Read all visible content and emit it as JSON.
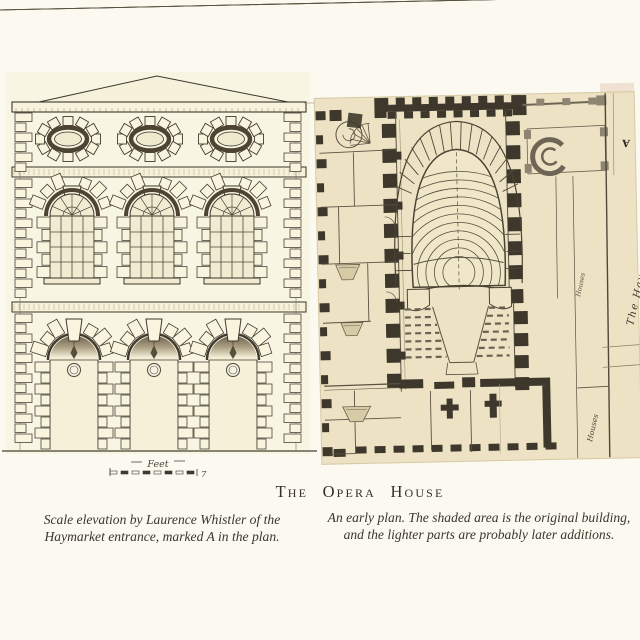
{
  "page": {
    "heading": "The Opera House",
    "caption_left": "Scale elevation by Laurence Whistler of the Haymarket entrance, marked A in the plan.",
    "caption_right": "An early plan. The shaded area is the original building, and the lighter parts are probably later additions."
  },
  "elevation": {
    "scale_label": "Feet",
    "scale_value": "7",
    "features": {
      "oval_windows": 3,
      "arched_windows": 3,
      "entrance_arches": 3
    }
  },
  "plan": {
    "marker": "A",
    "street_label": "The Haymarket",
    "houses_label_upper": "Houses",
    "houses_label_lower": "Houses"
  },
  "colors": {
    "page_bg": "#fbf9f0",
    "elevation_paper": "#f7f3dd",
    "plan_paper": "#ede3c4",
    "plan_wall": "#3e382c",
    "ink": "#3c362b",
    "light_wall": "#8d8471",
    "text": "#37322a"
  }
}
